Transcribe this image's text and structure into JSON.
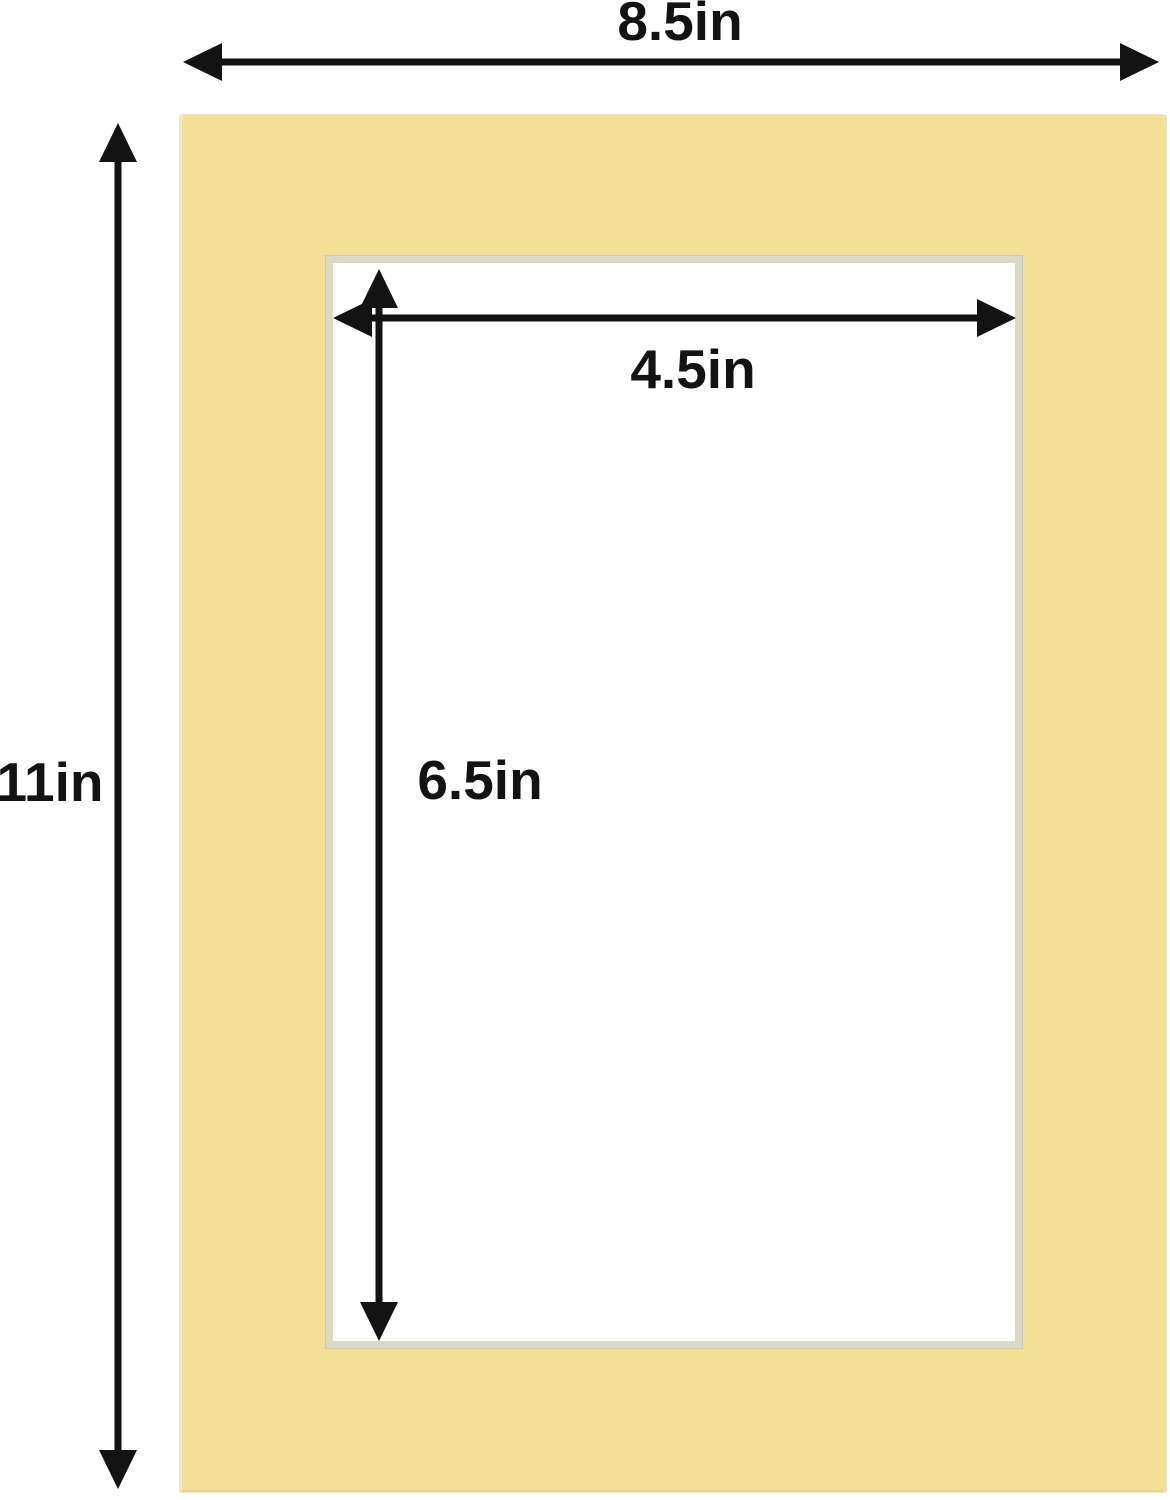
{
  "diagram": {
    "description": "Mat board dimension diagram",
    "labels": {
      "outer_width": "8.5in",
      "outer_height": "11in",
      "opening_width": "4.5in",
      "opening_height": "6.5in"
    },
    "colors": {
      "background": "#ffffff",
      "mat": "#f3e096",
      "mat_bevel": "#ded8c6",
      "arrow": "#131313"
    }
  }
}
